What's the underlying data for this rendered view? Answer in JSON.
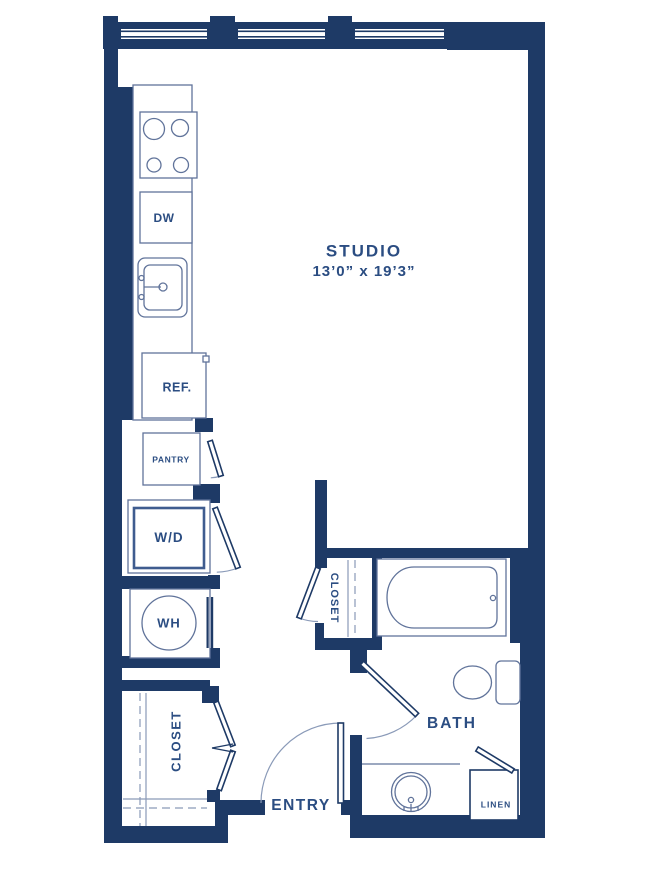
{
  "floor_plan": {
    "unit_type": "studio apartment",
    "labels": {
      "studio_name": "STUDIO",
      "studio_dims": "13’0” x 19’3”",
      "dw": "DW",
      "ref": "REF.",
      "pantry": "PANTRY",
      "wd": "W/D",
      "wh": "WH",
      "closet_utility": "CLOSET",
      "closet_bath": "CLOSET",
      "bath": "BATH",
      "entry": "ENTRY",
      "linen": "LINEN"
    },
    "colors": {
      "wall": "#1e3a66",
      "fixture": "#60739a",
      "light": "#8a9ab8",
      "label": "#2b4d82",
      "background": "#ffffff"
    }
  }
}
